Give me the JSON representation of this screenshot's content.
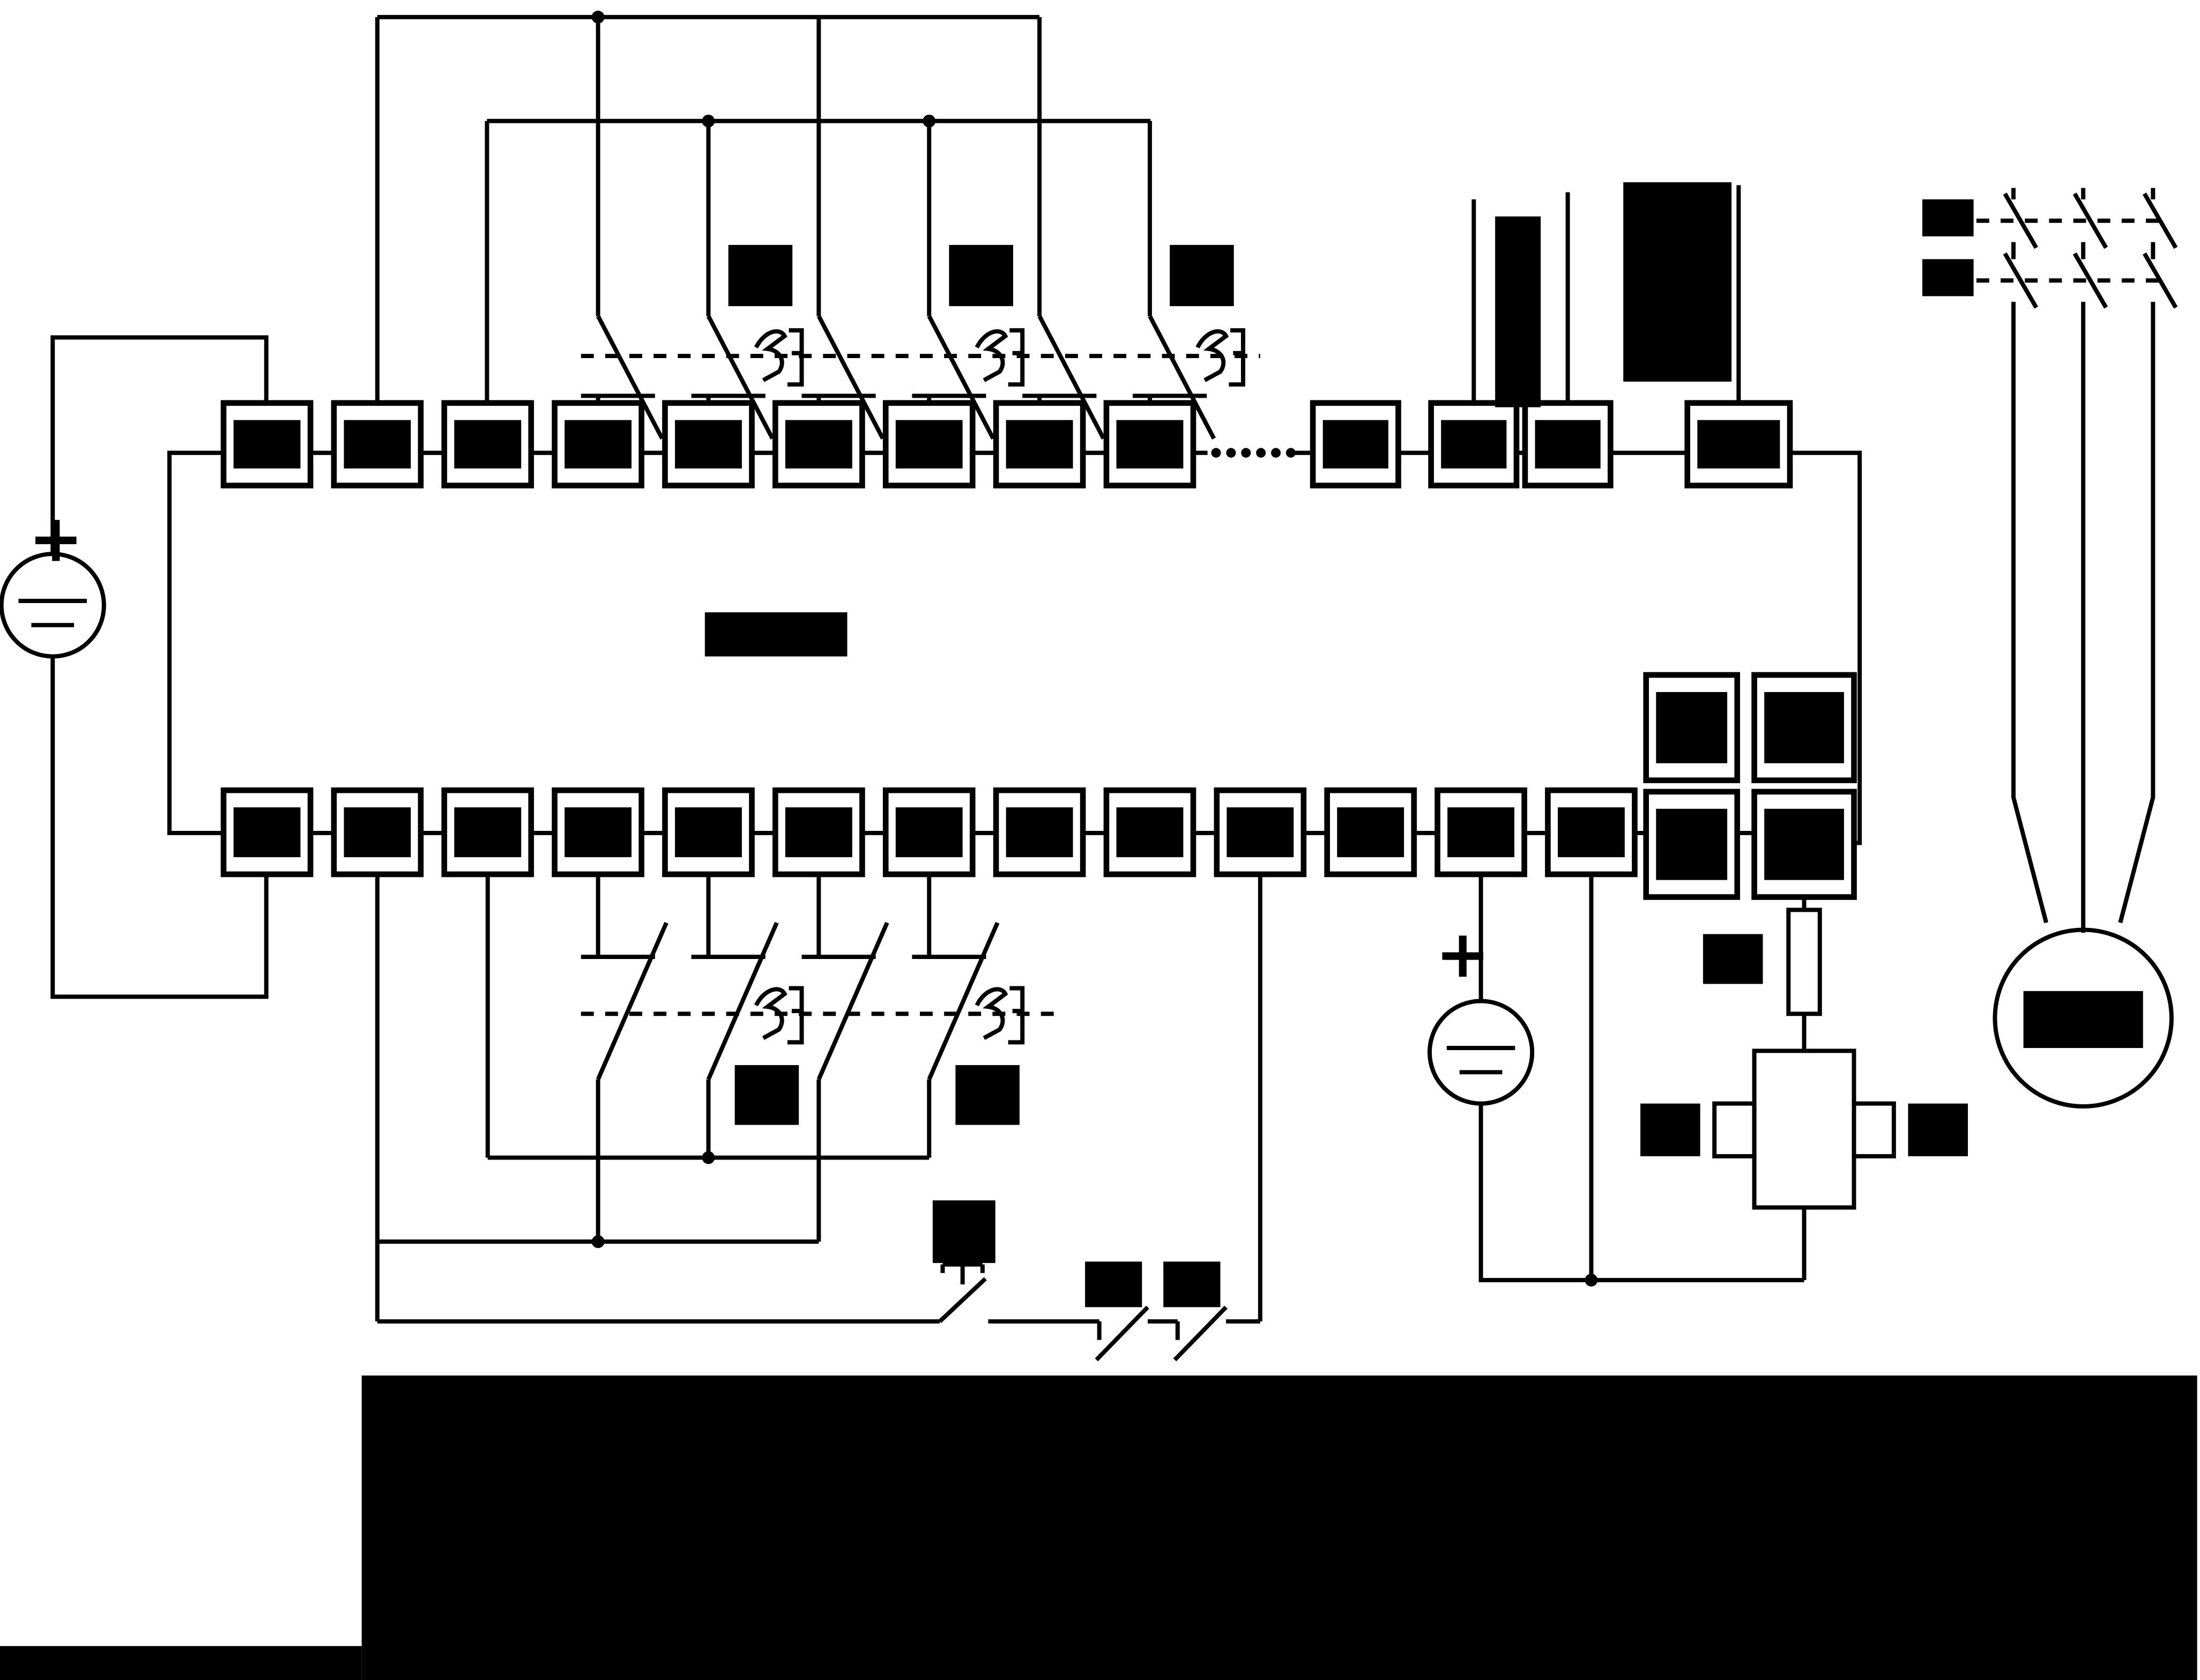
{
  "diagram": {
    "kind": "plc-wiring-schematic",
    "ink_color": "#000000",
    "background_color": "#ffffff",
    "labels_redacted": true,
    "dc_source_left": {
      "polarity_label": "+"
    },
    "dc_source_right": {
      "polarity_label": "+"
    },
    "continuation_dots_count": 6,
    "top_terminal_row": {
      "main_count": 9,
      "after_dots_count": 3,
      "detached_count": 1
    },
    "bottom_terminal_row": {
      "count": 13
    },
    "output_terminal_block": {
      "rows": 2,
      "cols": 2
    },
    "top_switch_groups": {
      "groups": 3,
      "poles_per_group": 2
    },
    "bottom_switch_groups": {
      "groups": 2,
      "poles_per_group": 2
    },
    "push_button_count": 1,
    "series_contact_count": 2,
    "fuse_count": 1,
    "coil_count": 1,
    "motor": {
      "phase_lines": 3,
      "contactor_rows": 2,
      "poles_per_row": 3
    },
    "redacted_label_boxes": {
      "top_switch_labels": 3,
      "sensor_bar": 1,
      "sensor_block": 1,
      "plc_model_label": 1,
      "bottom_switch_labels": 2,
      "push_button_label": 1,
      "series_contact_labels": 2,
      "fuse_label": 1,
      "coil_labels": 2,
      "contactor_row_labels": 2,
      "motor_label": 1
    },
    "caption_banner_redacted": true
  }
}
